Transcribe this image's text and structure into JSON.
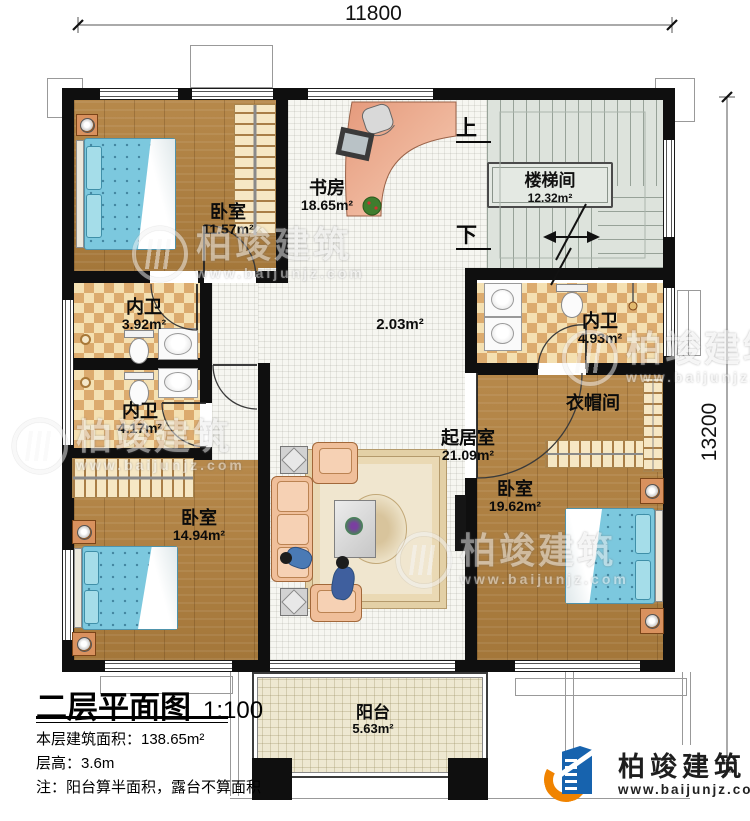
{
  "dimensions": {
    "top": "11800",
    "right": "13200"
  },
  "plan_title": {
    "title": "二层平面图",
    "scale": "1:100"
  },
  "notes": {
    "area": "本层建筑面积：138.65m²",
    "height": "层高：3.6m",
    "remark": "注：阳台算半面积，露台不算面积"
  },
  "rooms": {
    "bedroom_tl": {
      "name": "卧室",
      "area": "11.57m²"
    },
    "study": {
      "name": "书房",
      "area": "18.65m²"
    },
    "stairwell": {
      "name": "楼梯间",
      "area": "12.32m²"
    },
    "bath_left_upper": {
      "name": "内卫",
      "area": "3.92m²"
    },
    "bath_left_lower": {
      "name": "内卫",
      "area": "4.17m²"
    },
    "hall": {
      "area": "2.03m²"
    },
    "bath_right": {
      "name": "内卫",
      "area": "4.93m²"
    },
    "cloakroom": {
      "name": "衣帽间"
    },
    "living": {
      "name": "起居室",
      "area": "21.09m²"
    },
    "bedroom_bl": {
      "name": "卧室",
      "area": "14.94m²"
    },
    "bedroom_br": {
      "name": "卧室",
      "area": "19.62m²"
    },
    "balcony": {
      "name": "阳台",
      "area": "5.63m²"
    }
  },
  "stairs": {
    "up": "上",
    "down": "下"
  },
  "watermark": {
    "brand": "柏竣建筑",
    "url": "www.baijunjz.com"
  },
  "logo": {
    "brand": "柏竣建筑",
    "url": "www.baijunjz.com"
  },
  "colors": {
    "wall": "#0f0f0f",
    "wood_floor": "#b2813f",
    "tile_floor": "#f6f6f1",
    "checker_light": "#f4e0b2",
    "checker_dark": "#dcab6e",
    "stair_floor": "#dde3dc",
    "balcony_floor": "#eee8d1",
    "bed_blue": "#7cc8de",
    "sofa_peach": "#f0bf9a",
    "brand_blue": "#1763ae",
    "brand_orange": "#f08300"
  }
}
